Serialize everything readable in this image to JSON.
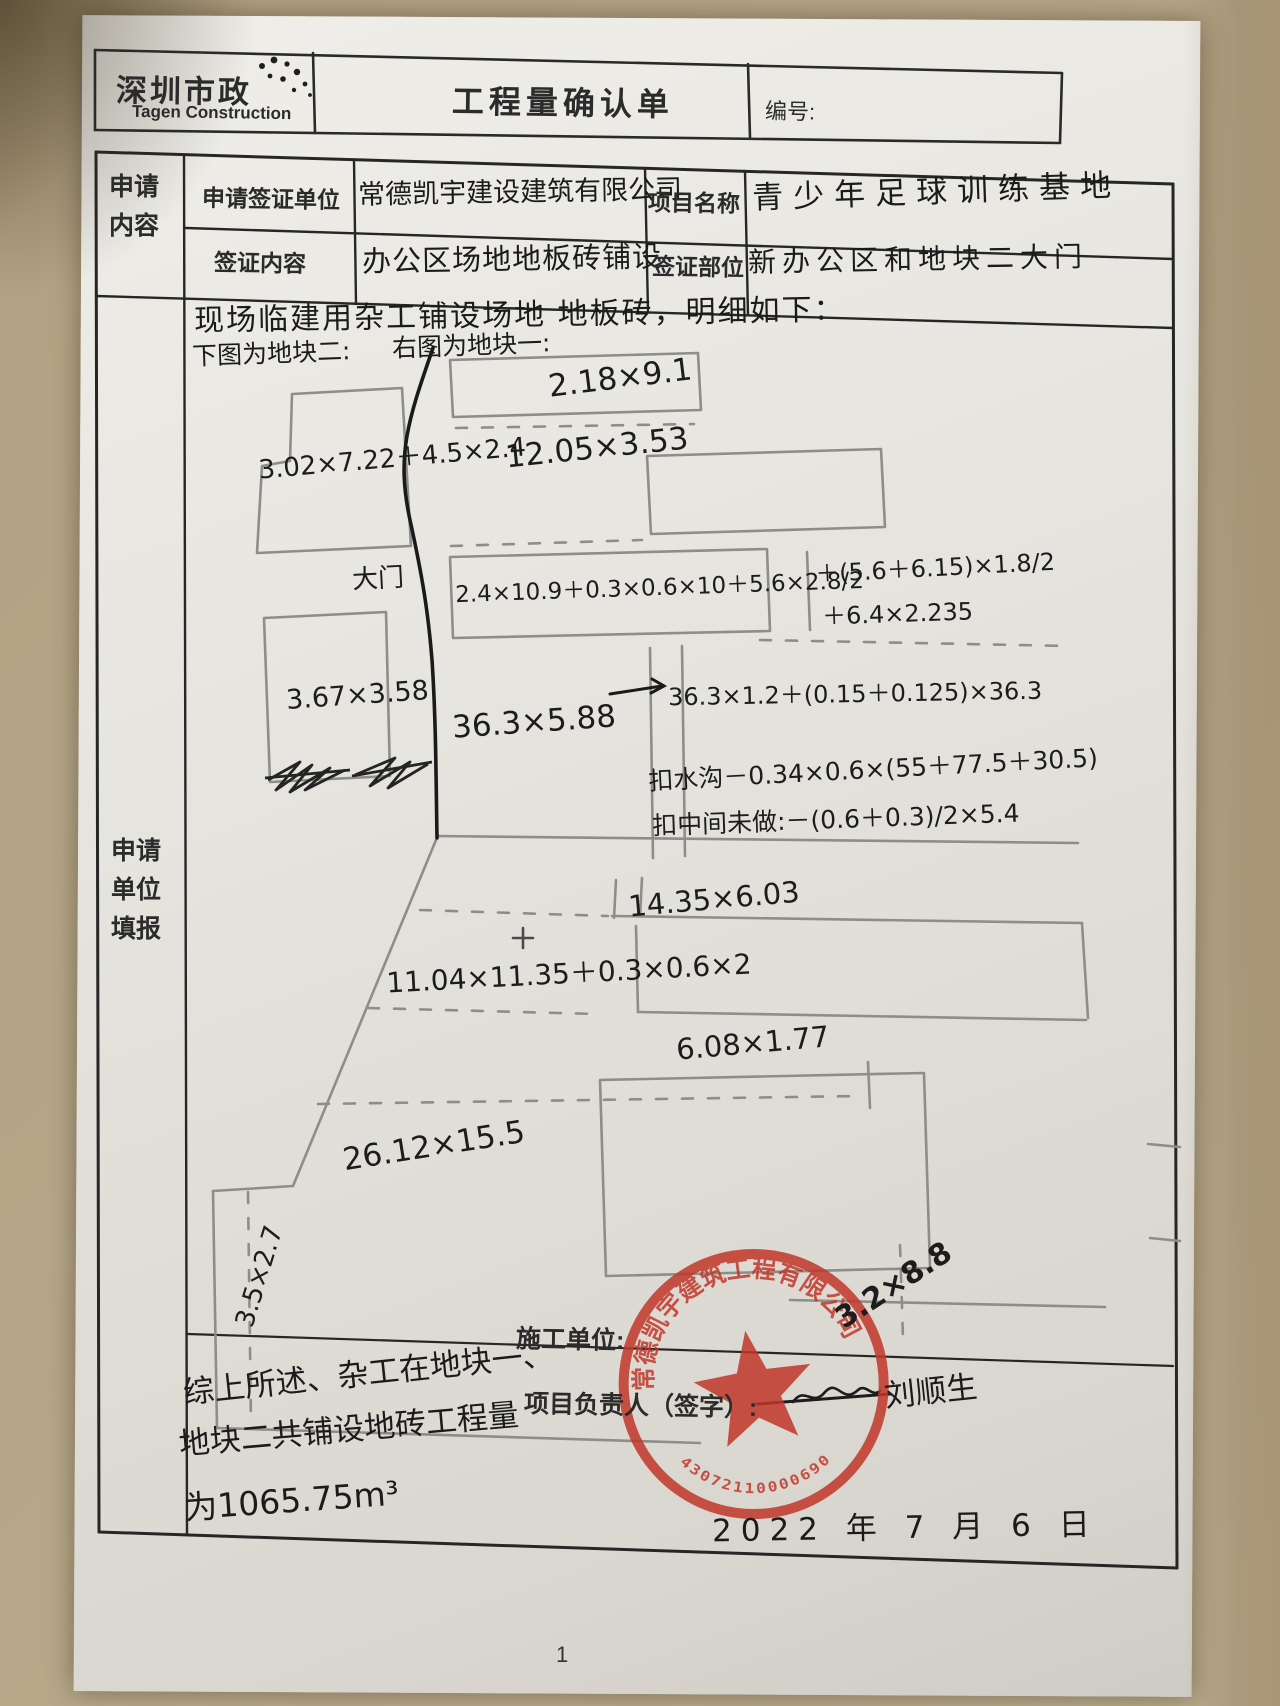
{
  "header": {
    "logo_cn": "深圳市政",
    "logo_en": "Tagen Construction",
    "title": "工程量确认单",
    "number_label": "编号:"
  },
  "form": {
    "left_label_top": "申请内容",
    "left_label_main": "申请单位填报",
    "row1": {
      "label": "申请签证单位",
      "value": "常德凯宇建设建筑有限公司",
      "label2": "项目名称",
      "value2": "青少年足球训练基地"
    },
    "row2": {
      "label": "签证内容",
      "value": "办公区场地地板砖铺设",
      "label2": "签证部位",
      "value2": "新办公区和地块二大门"
    }
  },
  "body": {
    "intro_line": "现场临建用杂工铺设场地 地板砖，明细如下：",
    "left_caption": "下图为地块二:",
    "right_caption": "右图为地块一:",
    "annotations": {
      "a1": "3.02×7.22＋4.5×2.4",
      "a2": "大门",
      "a3": "2.18×9.1",
      "a4": "12.05×3.53",
      "a5": "2.4×10.9＋0.3×0.6×10＋5.6×2.8/2",
      "a6": "＋(5.6＋6.15)×1.8/2",
      "a7": "＋6.4×2.235",
      "a8": "3.67×3.58",
      "a9": "36.3×5.88",
      "a10": "36.3×1.2＋(0.15＋0.125)×36.3",
      "a11": "扣水沟－0.34×0.6×(55＋77.5＋30.5)",
      "a12": "扣中间未做:－(0.6＋0.3)/2×5.4",
      "a13": "14.35×6.03",
      "a14": "11.04×11.35＋0.3×0.6×2",
      "a15": "6.08×1.77",
      "a16": "26.12×15.5",
      "a17": "3.5×2.7",
      "a18": "3.2×8.8"
    }
  },
  "footer": {
    "construction_unit_label": "施工单位:",
    "summary_line1": "综上所述、杂工在地块一、",
    "summary_line2": "地块二共铺设地砖工程量",
    "summary_line3": "为1065.75m³",
    "manager_label": "项目负责人（签字）:",
    "signature": "刘顺生",
    "date": "2022 年 7 月 6 日",
    "page_number": "1",
    "stamp": {
      "company": "常德凯宇建筑工程有限公司",
      "number": "43072110000690"
    }
  },
  "colors": {
    "stamp_red": "#c2372b",
    "pen_black": "#1c1c1c",
    "pencil_gray": "#8f8d89"
  }
}
